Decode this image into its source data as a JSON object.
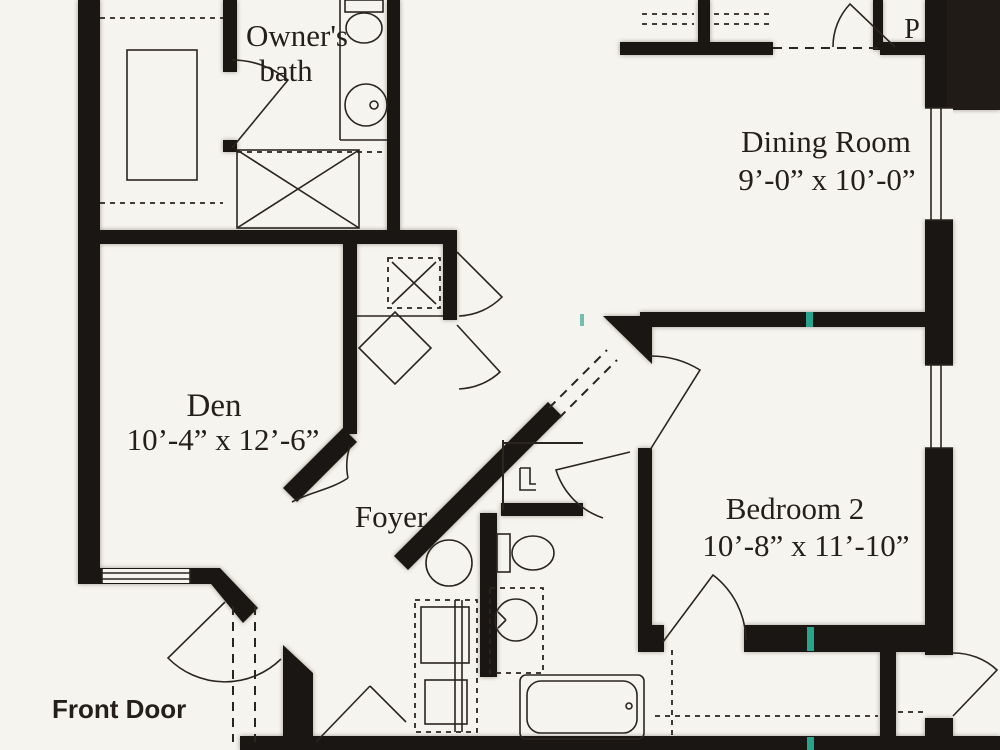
{
  "document_type": "scanned floor plan",
  "colors": {
    "paper": "#f6f4ef",
    "wall": "#1a1613",
    "line": "#2b2520",
    "registration_teal": "#2aa38c"
  },
  "rooms": {
    "owners_bath": {
      "name_line1": "Owner's",
      "name_line2": "bath"
    },
    "dining": {
      "name": "Dining Room",
      "dims": "9’-0” x 10’-0”"
    },
    "den": {
      "name": "Den",
      "dims": "10’-4” x 12’-6”"
    },
    "foyer": {
      "name": "Foyer"
    },
    "bedroom2": {
      "name": "Bedroom 2",
      "dims": "10’-8” x 11’-10”"
    },
    "pantry": {
      "label": "P"
    }
  },
  "annotations": {
    "front_door": "Front Door"
  },
  "fixtures": [
    "toilet-owners-bath",
    "sink-owners-bath",
    "linen-closet-x",
    "utility-washer-x",
    "water-heater-diamond",
    "pedestal-sink-hall",
    "hall-cabinets",
    "water-closet-toilet",
    "toilet-main-bath",
    "vanity-sink-main-bath",
    "bathtub",
    "bedroom2-closet"
  ]
}
